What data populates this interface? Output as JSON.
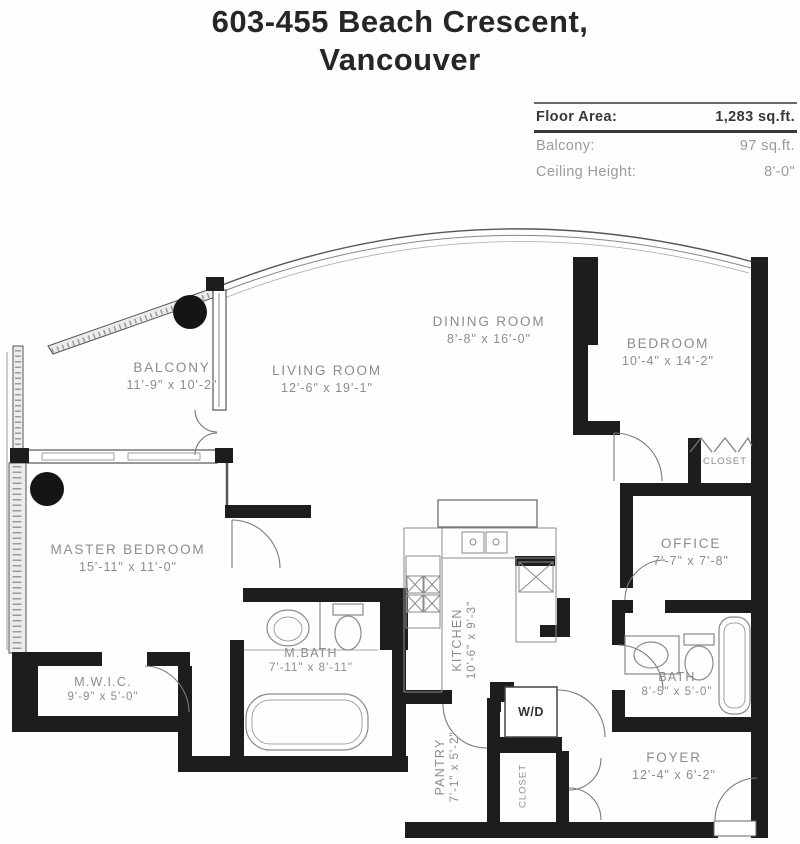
{
  "title": {
    "line1": "603-455 Beach Crescent,",
    "line2": "Vancouver"
  },
  "info": {
    "floor_area_label": "Floor Area:",
    "floor_area_value": "1,283 sq.ft.",
    "balcony_label": "Balcony:",
    "balcony_value": "97 sq.ft.",
    "ceiling_label": "Ceiling Height:",
    "ceiling_value": "8'-0\""
  },
  "rooms": {
    "balcony": {
      "name": "BALCONY",
      "dims": "11'-9\" x 10'-2\""
    },
    "living": {
      "name": "LIVING ROOM",
      "dims": "12'-6\" x 19'-1\""
    },
    "dining": {
      "name": "DINING ROOM",
      "dims": "8'-8\" x 16'-0\""
    },
    "bedroom": {
      "name": "BEDROOM",
      "dims": "10'-4\" x 14'-2\""
    },
    "closet_bedroom": {
      "name": "CLOSET"
    },
    "office": {
      "name": "OFFICE",
      "dims": "7'-7\" x 7'-8\""
    },
    "master": {
      "name": "MASTER BEDROOM",
      "dims": "15'-11\" x 11'-0\""
    },
    "mwic": {
      "name": "M.W.I.C.",
      "dims": "9'-9\" x 5'-0\""
    },
    "mbath": {
      "name": "M.BATH",
      "dims": "7'-11\" x 8'-11\""
    },
    "kitchen": {
      "name": "KITCHEN",
      "dims": "10'-6\" x 9'-3\""
    },
    "pantry": {
      "name": "PANTRY",
      "dims": "7'-1\" x 5'-2\""
    },
    "wd": {
      "name": "W/D"
    },
    "closet_foyer": {
      "name": "CLOSET"
    },
    "bath": {
      "name": "BATH",
      "dims": "8'-5\" x 5'-0\""
    },
    "foyer": {
      "name": "FOYER",
      "dims": "12'-4\" x 6'-2\""
    }
  },
  "colors": {
    "wall": "#1d1d1d",
    "label": "#8c8c8c"
  }
}
